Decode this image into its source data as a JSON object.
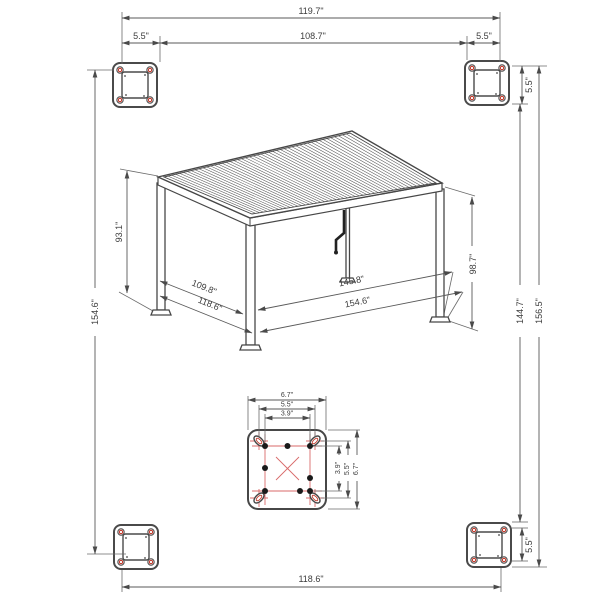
{
  "drawing": {
    "units": "inches",
    "colors": {
      "line": "#474747",
      "dimension_line": "#5a5a5a",
      "accent_red": "#c0392b",
      "construction_red": "#d96a6a",
      "background": "#ffffff"
    },
    "dims": {
      "top_overall": "119.7\"",
      "top_left_offset": "5.5\"",
      "top_inner": "108.7\"",
      "top_right_offset": "5.5\"",
      "left_overall": "154.6\"",
      "right_plate_top": "5.5\"",
      "right_inner": "144.7\"",
      "right_overall": "156.5\"",
      "right_plate_bottom": "5.5\"",
      "bottom_overall": "118.6\"",
      "post_left_height": "93.1\"",
      "post_right_height": "98.7\"",
      "side_depth_inner": "109.8\"",
      "side_depth_outer": "118.6\"",
      "front_width_inner": "145.8\"",
      "front_width_outer": "154.6\"",
      "plate_width_outer": "6.7\"",
      "plate_width_mid": "5.5\"",
      "plate_width_inner": "3.9\"",
      "plate_height_inner": "3.9\"",
      "plate_height_mid": "5.5\"",
      "plate_height_outer": "6.7\""
    }
  }
}
